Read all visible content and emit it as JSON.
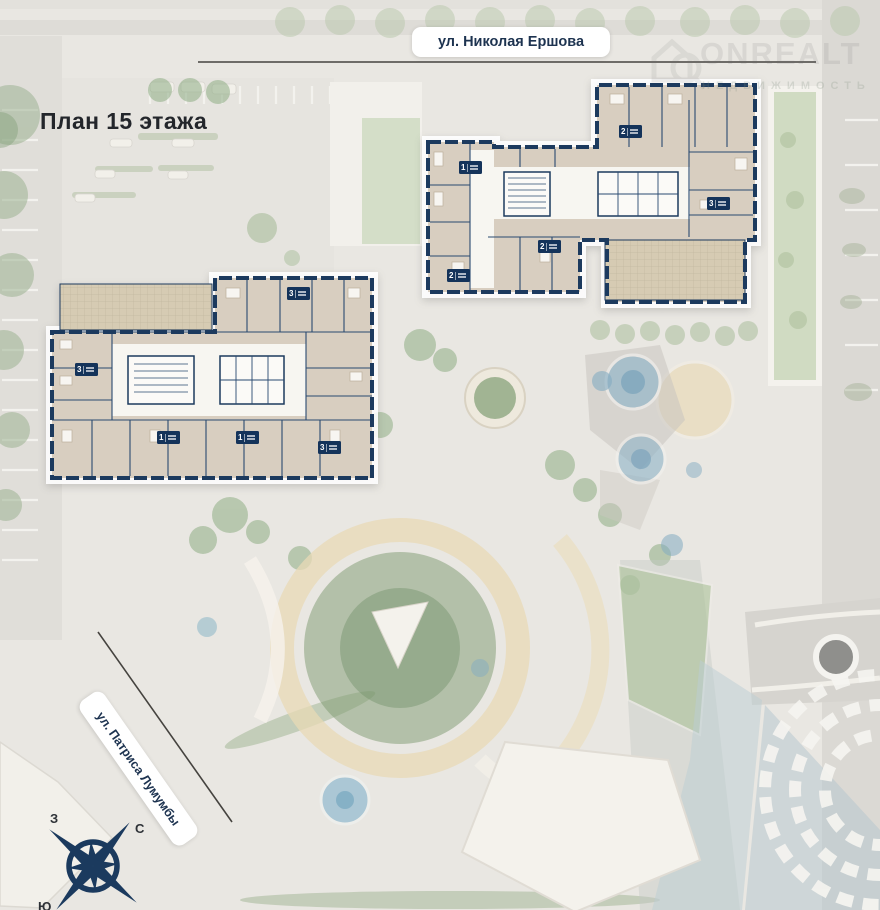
{
  "title": "План 15 этажа",
  "streets": {
    "top": "ул. Николая Ершова",
    "left": "ул. Патриса Лумумбы"
  },
  "watermark": {
    "brand": "ONREALT",
    "subtitle": "НЕДВИЖИМОСТЬ"
  },
  "compass": {
    "west": "З",
    "north": "С",
    "south": "Ю"
  },
  "plans": {
    "upper": {
      "badges": [
        {
          "num": "1"
        },
        {
          "num": "2"
        },
        {
          "num": "3"
        },
        {
          "num": "2"
        },
        {
          "num": "2"
        }
      ]
    },
    "left": {
      "badges": [
        {
          "num": "3"
        },
        {
          "num": "3"
        },
        {
          "num": "1"
        },
        {
          "num": "1"
        },
        {
          "num": "3"
        }
      ]
    }
  },
  "colors": {
    "wall_navy": "#1c3a5e",
    "room_beige": "#d8cec0",
    "badge_navy": "#14335a",
    "map_green": "#9db393",
    "path_tan": "#e8d9b6",
    "water_blue": "#9cc0d2",
    "title_text": "#23262b"
  }
}
